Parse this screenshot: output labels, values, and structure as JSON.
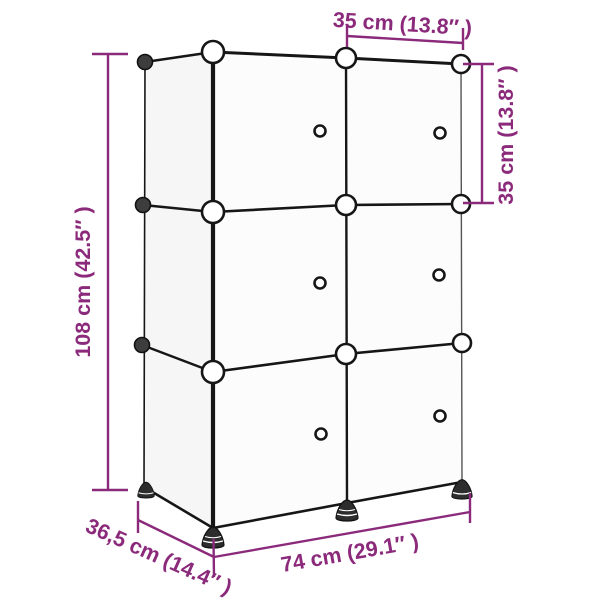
{
  "diagram": {
    "kind": "product-dimension-diagram",
    "subject": "cube storage organizer with doors",
    "structure": {
      "rows": 3,
      "columns": 2,
      "doors": 6,
      "door_knobs": 6,
      "corner_connectors": 12
    },
    "colors": {
      "dimension_accent": "#8B2A7B",
      "outline": "#161616",
      "right_edge": "#555555",
      "front_face_fill": "#fcfcfc",
      "side_face_fill": "#f6f6f6",
      "background": "#ffffff"
    },
    "dimensions": {
      "top_width": {
        "label": "35 cm (13.8″ )",
        "cm": "35",
        "inches": "13.8"
      },
      "right_height": {
        "label": "35 cm (13.8″ )",
        "cm": "35",
        "inches": "13.8"
      },
      "left_height": {
        "label": "108 cm (42.5″ )",
        "cm": "108",
        "inches": "42.5"
      },
      "bottom_width": {
        "label": "74 cm (29.1″ )",
        "cm": "74",
        "inches": "29.1"
      },
      "depth": {
        "label": "36,5 cm (14.4″ )",
        "cm": "36,5",
        "inches": "14.4"
      }
    }
  }
}
